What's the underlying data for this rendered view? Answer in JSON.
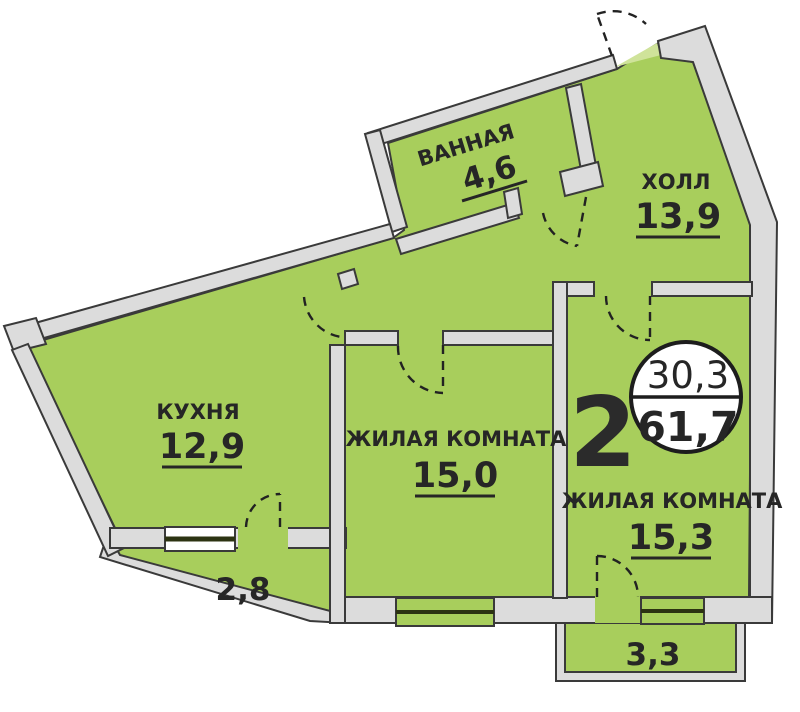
{
  "plan": {
    "apartment_number": "2",
    "area_circle": {
      "top": "30,3",
      "bottom": "61,7"
    },
    "rooms": [
      {
        "name": "ВАННАЯ",
        "area": "4,6"
      },
      {
        "name": "ХОЛЛ",
        "area": "13,9"
      },
      {
        "name": "КУХНЯ",
        "area": "12,9"
      },
      {
        "name": "ЖИЛАЯ КОМНАТА",
        "area": "15,0"
      },
      {
        "name": "ЖИЛАЯ КОМНАТА",
        "area": "15,3"
      }
    ],
    "balconies": [
      {
        "area": "2,8"
      },
      {
        "area": "3,3"
      }
    ],
    "colors": {
      "floor": "#a8ce5c",
      "floor_light": "#cfe39a",
      "wall_fill": "#dcdcdc",
      "wall_stroke": "#3a3a3a",
      "text": "#262626"
    }
  }
}
